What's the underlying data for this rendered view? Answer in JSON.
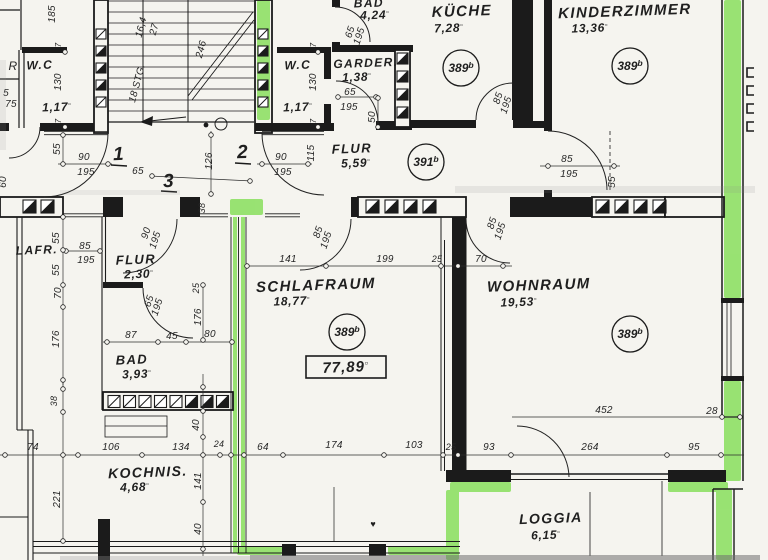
{
  "title": "Grundriss Wohnung (floor plan)",
  "colors": {
    "paper": "#f5f4ef",
    "ink": "#1b1b1b",
    "dim_line": "#2e2e2e",
    "highlight": "#7fdd4f"
  },
  "unit_mark": "▫",
  "apartment_numbers": [
    "1",
    "2",
    "3"
  ],
  "total_area_boxed": "77,89",
  "reference_circles": [
    "389b",
    "391b"
  ],
  "rooms": [
    {
      "name": "W.C",
      "area": "1,17"
    },
    {
      "name": "W.C",
      "area": "1,17"
    },
    {
      "name": "BAD",
      "area": "4,24"
    },
    {
      "name": "GARDER.",
      "area": "1,38"
    },
    {
      "name": "KÜCHE",
      "area": "7,28",
      "ref": "389b"
    },
    {
      "name": "KINDERZIMMER",
      "area": "13,36",
      "ref": "389b"
    },
    {
      "name": "FLUR",
      "area": "5,59",
      "ref": "391b"
    },
    {
      "name": "FLUR",
      "area": "2,30"
    },
    {
      "name": "BAD",
      "area": "3,93"
    },
    {
      "name": "SCHLAFRAUM",
      "area": "18,77",
      "ref": "389b"
    },
    {
      "name": "WOHNRAUM",
      "area": "19,53",
      "ref": "389b"
    },
    {
      "name": "KOCHNIS.",
      "area": "4,68"
    },
    {
      "name": "LOGGIA",
      "area": "6,15"
    }
  ],
  "labels": [
    {
      "t": "185",
      "x": 55,
      "y": 14,
      "k": "dim",
      "r": -90
    },
    {
      "t": "R",
      "x": 13,
      "y": 70,
      "k": "dim",
      "s": 12
    },
    {
      "t": "W.C",
      "x": 40,
      "y": 69,
      "k": "room",
      "s": 12
    },
    {
      "t": "130",
      "x": 61,
      "y": 82,
      "k": "dim",
      "r": -90
    },
    {
      "t": "5",
      "x": 6,
      "y": 96,
      "k": "dim"
    },
    {
      "t": "75",
      "x": 11,
      "y": 107,
      "k": "dim"
    },
    {
      "t": "1,17",
      "x": 57,
      "y": 111,
      "k": "area",
      "s": 12
    },
    {
      "t": "7",
      "x": 61,
      "y": 45,
      "k": "dim",
      "r": -90,
      "s": 8
    },
    {
      "t": "7",
      "x": 61,
      "y": 121,
      "k": "dim",
      "r": -90,
      "s": 8
    },
    {
      "t": "55",
      "x": 60,
      "y": 149,
      "k": "dim",
      "r": -90
    },
    {
      "t": "90",
      "x": 84,
      "y": 160,
      "k": "dim"
    },
    {
      "t": "195",
      "x": 86,
      "y": 175,
      "k": "dim"
    },
    {
      "t": "1",
      "x": 119,
      "y": 160,
      "k": "big"
    },
    {
      "t": "16,4",
      "x": 144,
      "y": 28,
      "k": "dim",
      "r": -75
    },
    {
      "t": "27",
      "x": 157,
      "y": 30,
      "k": "dim",
      "r": -75
    },
    {
      "t": "18 STG.",
      "x": 140,
      "y": 84,
      "k": "dim",
      "r": -75
    },
    {
      "t": "246",
      "x": 204,
      "y": 50,
      "k": "dim",
      "r": -75
    },
    {
      "t": "126",
      "x": 212,
      "y": 161,
      "k": "dim",
      "r": -90
    },
    {
      "t": "2",
      "x": 243,
      "y": 158,
      "k": "big"
    },
    {
      "t": "65",
      "x": 138,
      "y": 174,
      "k": "dim"
    },
    {
      "t": "3",
      "x": 169,
      "y": 187,
      "k": "big"
    },
    {
      "t": "60",
      "x": 6,
      "y": 182,
      "k": "dim",
      "r": -90
    },
    {
      "t": "W.C",
      "x": 298,
      "y": 69,
      "k": "room",
      "s": 12
    },
    {
      "t": "130",
      "x": 316,
      "y": 82,
      "k": "dim",
      "r": -90
    },
    {
      "t": "1,17",
      "x": 298,
      "y": 111,
      "k": "area",
      "s": 12
    },
    {
      "t": "7",
      "x": 316,
      "y": 45,
      "k": "dim",
      "r": -90,
      "s": 8
    },
    {
      "t": "7",
      "x": 316,
      "y": 121,
      "k": "dim",
      "r": -90,
      "s": 8
    },
    {
      "t": "BAD",
      "x": 369,
      "y": 7,
      "k": "room",
      "s": 12
    },
    {
      "t": "4,24",
      "x": 375,
      "y": 19,
      "k": "area",
      "s": 12
    },
    {
      "t": "65",
      "x": 353,
      "y": 33,
      "k": "dim",
      "r": -72
    },
    {
      "t": "195",
      "x": 362,
      "y": 37,
      "k": "dim",
      "r": -72
    },
    {
      "t": "GARDER.",
      "x": 366,
      "y": 67,
      "k": "room",
      "s": 12
    },
    {
      "t": "1,38",
      "x": 357,
      "y": 81,
      "k": "area",
      "s": 12
    },
    {
      "t": "65",
      "x": 350,
      "y": 95,
      "k": "dim"
    },
    {
      "t": "195",
      "x": 349,
      "y": 110,
      "k": "dim"
    },
    {
      "t": "50",
      "x": 375,
      "y": 117,
      "k": "dim",
      "r": -90
    },
    {
      "t": "KÜCHE",
      "x": 462,
      "y": 16,
      "k": "room",
      "s": 15
    },
    {
      "t": "7,28",
      "x": 449,
      "y": 32,
      "k": "area"
    },
    {
      "t": "389",
      "sup": "b",
      "x": 461,
      "y": 68,
      "k": "ref"
    },
    {
      "t": "85",
      "x": 501,
      "y": 99,
      "k": "dim",
      "r": -72
    },
    {
      "t": "195",
      "x": 509,
      "y": 106,
      "k": "dim",
      "r": -72
    },
    {
      "t": "KINDERZIMMER",
      "x": 625,
      "y": 16,
      "k": "room",
      "s": 15
    },
    {
      "t": "13,36",
      "x": 590,
      "y": 32,
      "k": "area"
    },
    {
      "t": "389",
      "sup": "b",
      "x": 630,
      "y": 66,
      "k": "ref"
    },
    {
      "t": "FLUR",
      "x": 352,
      "y": 153,
      "k": "room",
      "s": 13
    },
    {
      "t": "5,59",
      "x": 356,
      "y": 167,
      "k": "area"
    },
    {
      "t": "391",
      "sup": "b",
      "x": 426,
      "y": 162,
      "k": "ref"
    },
    {
      "t": "90",
      "x": 281,
      "y": 160,
      "k": "dim"
    },
    {
      "t": "195",
      "x": 283,
      "y": 175,
      "k": "dim"
    },
    {
      "t": "115",
      "x": 314,
      "y": 153,
      "k": "dim",
      "r": -90
    },
    {
      "t": "85",
      "x": 567,
      "y": 162,
      "k": "dim"
    },
    {
      "t": "195",
      "x": 569,
      "y": 177,
      "k": "dim"
    },
    {
      "t": "55",
      "x": 615,
      "y": 182,
      "k": "dim",
      "r": -90
    },
    {
      "t": "38",
      "x": 205,
      "y": 208,
      "k": "dim",
      "r": -90,
      "s": 9
    },
    {
      "t": "90",
      "x": 149,
      "y": 234,
      "k": "dim",
      "r": -72
    },
    {
      "t": "195",
      "x": 158,
      "y": 241,
      "k": "dim",
      "r": -72
    },
    {
      "t": "85",
      "x": 321,
      "y": 233,
      "k": "dim",
      "r": -72
    },
    {
      "t": "195",
      "x": 329,
      "y": 241,
      "k": "dim",
      "r": -72
    },
    {
      "t": "85",
      "x": 495,
      "y": 224,
      "k": "dim",
      "r": -72
    },
    {
      "t": "195",
      "x": 503,
      "y": 232,
      "k": "dim",
      "r": -72
    },
    {
      "t": "LAFR.",
      "x": 37,
      "y": 254,
      "k": "room",
      "s": 12
    },
    {
      "t": "85",
      "x": 85,
      "y": 249,
      "k": "dim"
    },
    {
      "t": "195",
      "x": 86,
      "y": 263,
      "k": "dim"
    },
    {
      "t": "55",
      "x": 59,
      "y": 238,
      "k": "dim",
      "r": -90
    },
    {
      "t": "55",
      "x": 59,
      "y": 270,
      "k": "dim",
      "r": -90
    },
    {
      "t": "70",
      "x": 61,
      "y": 293,
      "k": "dim",
      "r": -90
    },
    {
      "t": "176",
      "x": 59,
      "y": 339,
      "k": "dim",
      "r": -90
    },
    {
      "t": "FLUR",
      "x": 136,
      "y": 264,
      "k": "room",
      "s": 13
    },
    {
      "t": "2,30",
      "x": 139,
      "y": 278,
      "k": "area"
    },
    {
      "t": "65",
      "x": 152,
      "y": 302,
      "k": "dim",
      "r": -72
    },
    {
      "t": "195",
      "x": 160,
      "y": 308,
      "k": "dim",
      "r": -72
    },
    {
      "t": "25",
      "x": 199,
      "y": 288,
      "k": "dim",
      "r": -90,
      "s": 9
    },
    {
      "t": "176",
      "x": 201,
      "y": 317,
      "k": "dim",
      "r": -90
    },
    {
      "t": "87",
      "x": 131,
      "y": 338,
      "k": "dim"
    },
    {
      "t": "45",
      "x": 172,
      "y": 339,
      "k": "dim"
    },
    {
      "t": "80",
      "x": 210,
      "y": 337,
      "k": "dim"
    },
    {
      "t": "BAD",
      "x": 132,
      "y": 364,
      "k": "room",
      "s": 13
    },
    {
      "t": "3,93",
      "x": 137,
      "y": 378,
      "k": "area"
    },
    {
      "t": "141",
      "x": 288,
      "y": 262,
      "k": "dim"
    },
    {
      "t": "199",
      "x": 385,
      "y": 262,
      "k": "dim"
    },
    {
      "t": "25",
      "x": 437,
      "y": 262,
      "k": "dim",
      "s": 9
    },
    {
      "t": "70",
      "x": 481,
      "y": 262,
      "k": "dim"
    },
    {
      "t": "SCHLAFRAUM",
      "x": 316,
      "y": 290,
      "k": "room",
      "s": 15
    },
    {
      "t": "18,77",
      "x": 292,
      "y": 305,
      "k": "area"
    },
    {
      "t": "389",
      "sup": "b",
      "x": 347,
      "y": 332,
      "k": "ref"
    },
    {
      "t": "77,89",
      "x": 346,
      "y": 372,
      "k": "boxed"
    },
    {
      "t": "WOHNRAUM",
      "x": 539,
      "y": 290,
      "k": "room",
      "s": 15
    },
    {
      "t": "19,53",
      "x": 519,
      "y": 306,
      "k": "area"
    },
    {
      "t": "389",
      "sup": "b",
      "x": 630,
      "y": 334,
      "k": "ref"
    },
    {
      "t": "38",
      "x": 57,
      "y": 401,
      "k": "dim",
      "r": -90,
      "s": 9
    },
    {
      "t": "40",
      "x": 199,
      "y": 425,
      "k": "dim",
      "r": -90
    },
    {
      "t": "74",
      "x": 33,
      "y": 450,
      "k": "dim"
    },
    {
      "t": "106",
      "x": 111,
      "y": 450,
      "k": "dim"
    },
    {
      "t": "134",
      "x": 181,
      "y": 450,
      "k": "dim"
    },
    {
      "t": "24",
      "x": 219,
      "y": 447,
      "k": "dim",
      "s": 9
    },
    {
      "t": "64",
      "x": 263,
      "y": 450,
      "k": "dim"
    },
    {
      "t": "174",
      "x": 334,
      "y": 448,
      "k": "dim"
    },
    {
      "t": "103",
      "x": 414,
      "y": 448,
      "k": "dim"
    },
    {
      "t": "25",
      "x": 451,
      "y": 450,
      "k": "dim",
      "s": 9
    },
    {
      "t": "93",
      "x": 489,
      "y": 450,
      "k": "dim"
    },
    {
      "t": "264",
      "x": 590,
      "y": 450,
      "k": "dim"
    },
    {
      "t": "95",
      "x": 694,
      "y": 450,
      "k": "dim"
    },
    {
      "t": "452",
      "x": 604,
      "y": 413,
      "k": "dim"
    },
    {
      "t": "28",
      "x": 712,
      "y": 414,
      "k": "dim"
    },
    {
      "t": "KOCHNIS.",
      "x": 148,
      "y": 477,
      "k": "room",
      "s": 14
    },
    {
      "t": "4,68",
      "x": 135,
      "y": 491,
      "k": "area"
    },
    {
      "t": "221",
      "x": 60,
      "y": 499,
      "k": "dim",
      "r": -90
    },
    {
      "t": "141",
      "x": 201,
      "y": 481,
      "k": "dim",
      "r": -90
    },
    {
      "t": "40",
      "x": 201,
      "y": 529,
      "k": "dim",
      "r": -90
    },
    {
      "t": "LOGGIA",
      "x": 551,
      "y": 523,
      "k": "room",
      "s": 14
    },
    {
      "t": "6,15",
      "x": 546,
      "y": 539,
      "k": "area"
    },
    {
      "t": "♥",
      "x": 373,
      "y": 527,
      "k": "blot"
    }
  ]
}
